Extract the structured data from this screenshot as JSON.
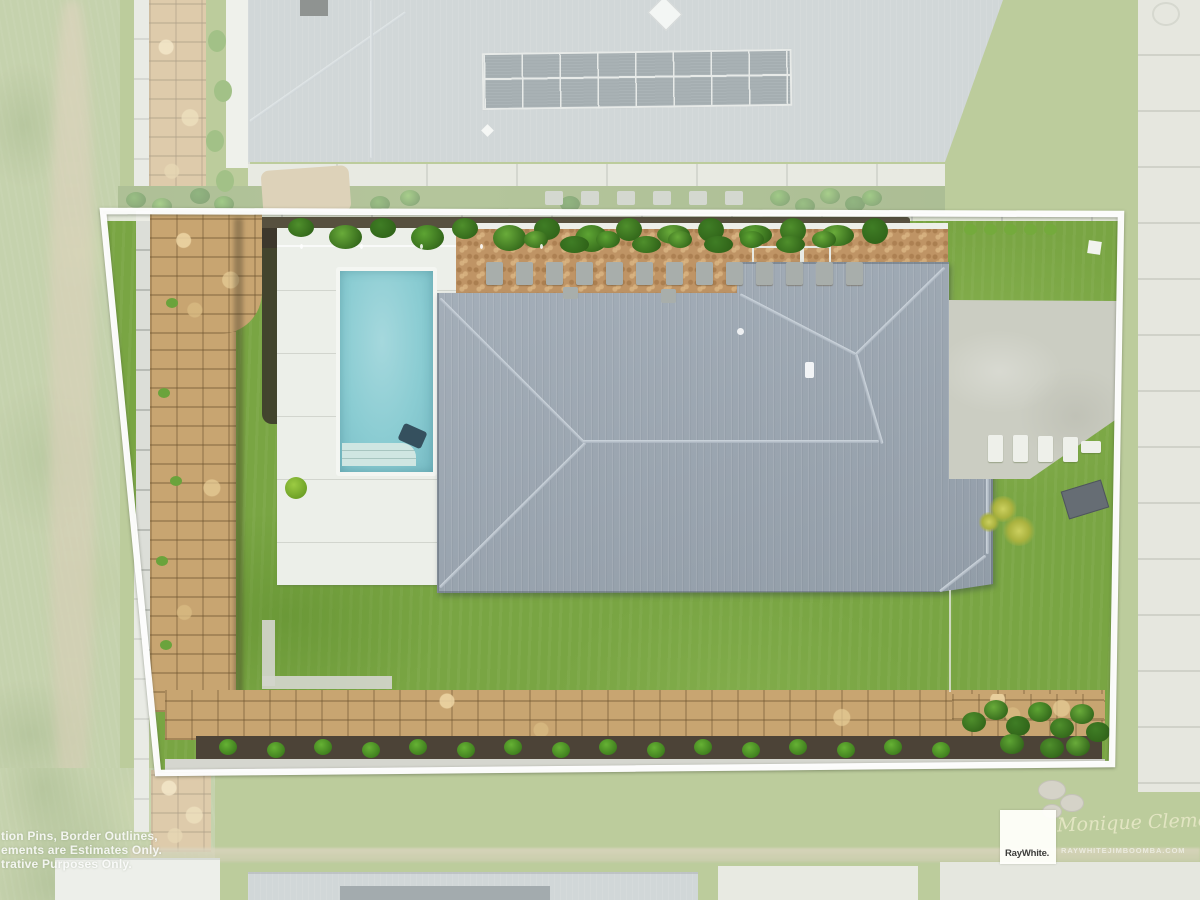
{
  "watermark": {
    "disclaimer_lines": [
      "tion Pins, Border Outlines,",
      "ements are Estimates Only.",
      "trative Purposes Only."
    ]
  },
  "branding": {
    "logo_text": "RayWhite.",
    "agent_signature": "Monique Clemens",
    "agency_url_text": "RAYWHITEJIMBOOMBA.COM"
  },
  "scene": {
    "colors": {
      "boundary_outline": "#ffffff",
      "property_lawn": "#79a543",
      "faded_surroundings": "#c8d2b2",
      "house_roof": "#9ea9b4",
      "neighbor_roof": "#b1b9c0",
      "solar_panels": "#62707c",
      "pool_water": "#8accd2",
      "pool_deck": "#ecefe9",
      "sandstone_wall": "#c8a571",
      "garden_mulch": "#4c4337",
      "shrubs": "#55a02b",
      "gravel_path": "#bf9465",
      "concrete": "#cbcdc2"
    }
  }
}
